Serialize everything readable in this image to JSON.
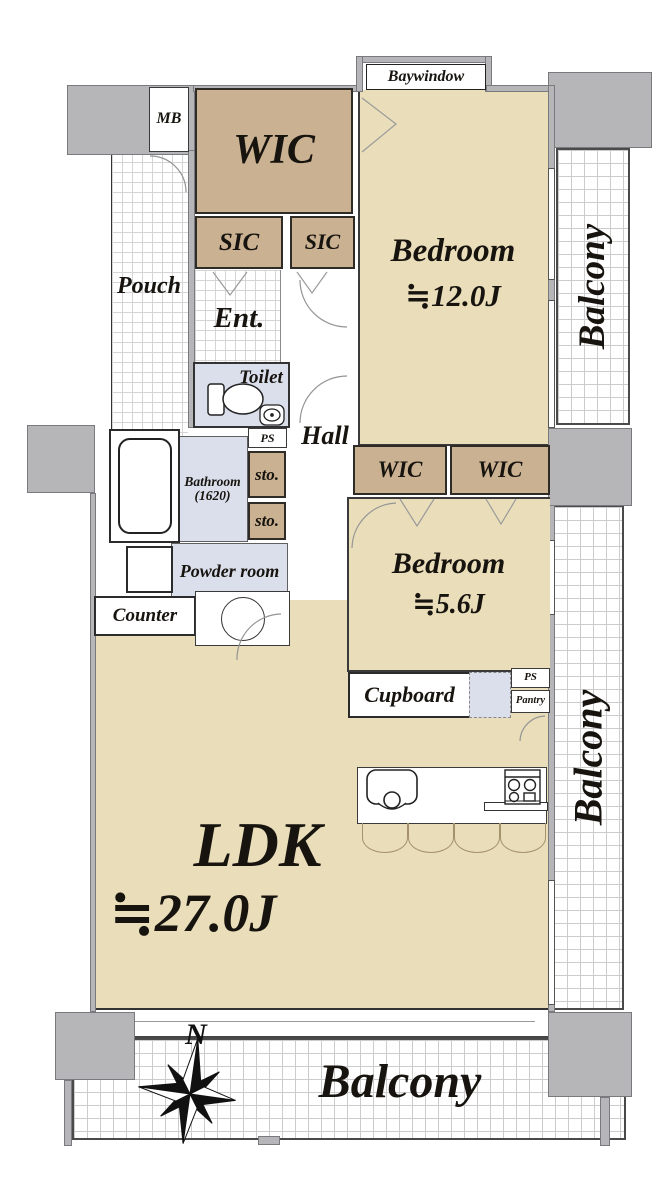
{
  "rooms": {
    "wic_main": {
      "label": "WIC"
    },
    "sic_left": {
      "label": "SIC"
    },
    "sic_right": {
      "label": "SIC"
    },
    "pouch": {
      "label": "Pouch"
    },
    "ent": {
      "label": "Ent."
    },
    "toilet": {
      "label": "Toilet"
    },
    "hall": {
      "label": "Hall"
    },
    "ps_top": {
      "label": "PS"
    },
    "sto_top": {
      "label": "sto."
    },
    "sto_bottom": {
      "label": "sto."
    },
    "bathroom": {
      "label": "Bathroom",
      "size": "(1620)"
    },
    "powder_room": {
      "label": "Powder room"
    },
    "counter": {
      "label": "Counter"
    },
    "bedroom_main": {
      "label": "Bedroom",
      "size": "≒12.0J"
    },
    "wic_small_left": {
      "label": "WIC"
    },
    "wic_small_right": {
      "label": "WIC"
    },
    "bedroom_second": {
      "label": "Bedroom",
      "size": "≒5.6J"
    },
    "cupboard": {
      "label": "Cupboard"
    },
    "ps_bottom": {
      "label": "PS"
    },
    "pantry": {
      "label": "Pantry"
    },
    "ldk": {
      "label": "LDK",
      "size": "≒27.0J"
    },
    "mb": {
      "label": "MB"
    },
    "baywindow": {
      "label": "Baywindow"
    },
    "balcony_right_top": {
      "label": "Balcony"
    },
    "balcony_right_bottom": {
      "label": "Balcony"
    },
    "balcony_bottom": {
      "label": "Balcony"
    }
  },
  "compass": {
    "north_label": "N"
  },
  "colors": {
    "floor_beige": "#e9ddba",
    "closet_tan": "#c9b191",
    "wet_area_blue": "#dadfeb",
    "wall_gray": "#b6b6b8",
    "line_dark": "#2f2b26"
  }
}
